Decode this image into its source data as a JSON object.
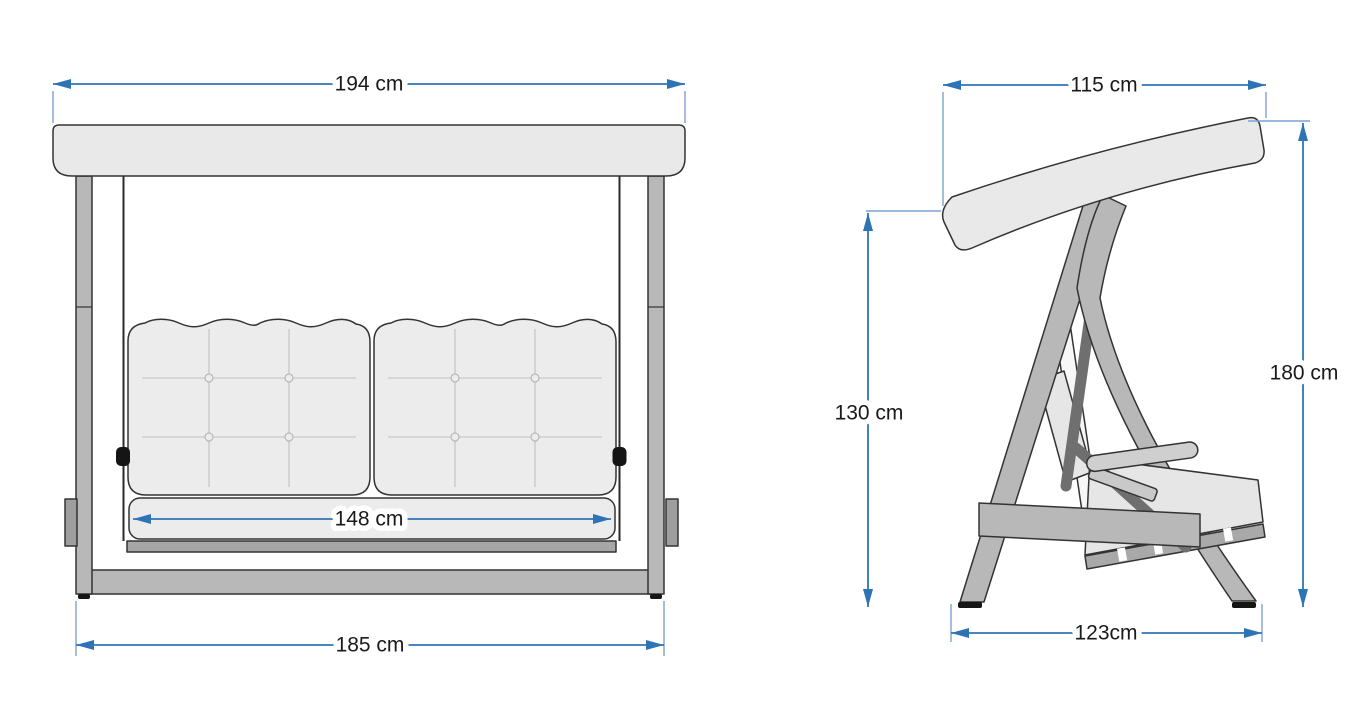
{
  "dimensions": {
    "front": {
      "canopy_width": "194 cm",
      "seat_width": "148 cm",
      "base_width": "185 cm"
    },
    "side": {
      "canopy_depth": "115 cm",
      "height_rear": "130 cm",
      "height_total": "180 cm",
      "base_depth": "123cm"
    }
  },
  "colors": {
    "dimension_line": "#2E74B5",
    "extension_line": "#7BA3D4",
    "label_text": "#1A1A1A",
    "outline": "#333333",
    "canopy_fill": "#E9E9E9",
    "cushion_fill": "#ECECEC",
    "frame_fill": "#B8B8B8",
    "dark_link_fill": "#6F6F6F",
    "background": "#FFFFFF"
  }
}
